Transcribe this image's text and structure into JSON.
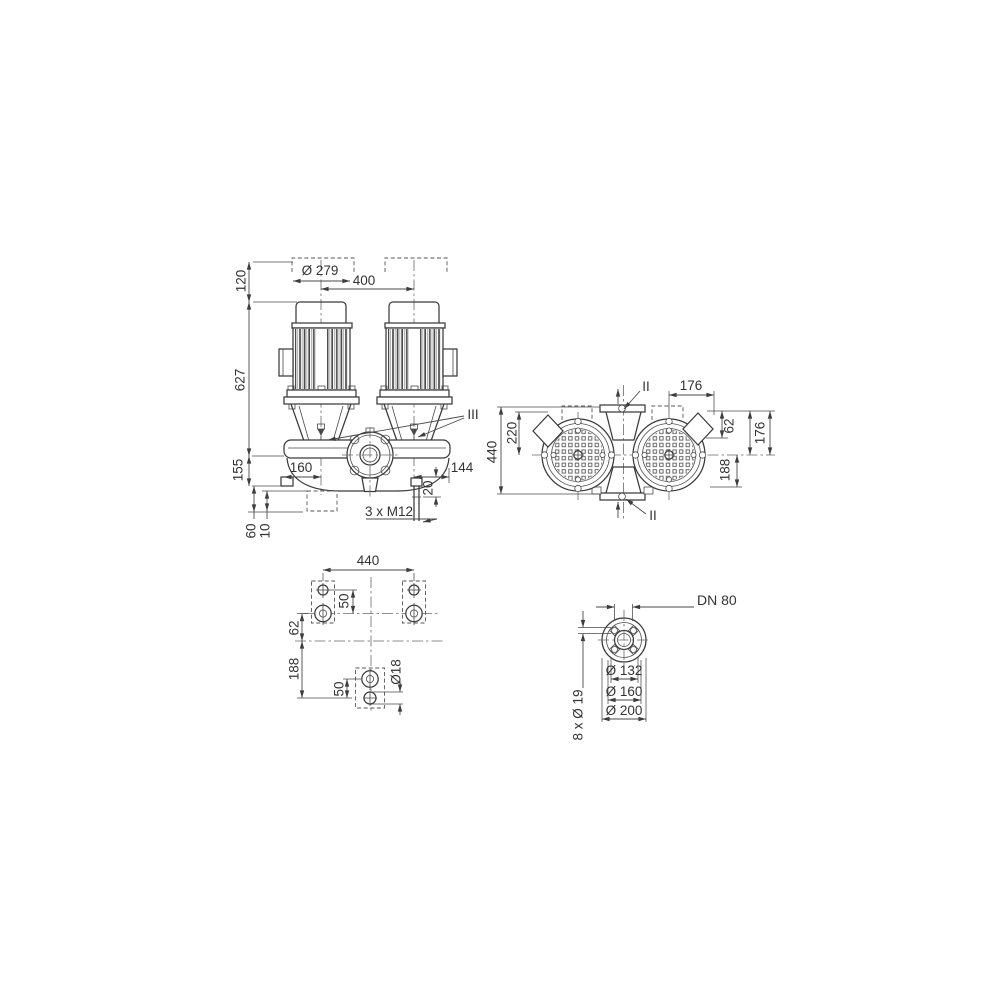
{
  "front": {
    "d120": "120",
    "d627": "627",
    "d155": "155",
    "d279": "Ø 279",
    "d400": "400",
    "d160": "160",
    "d144": "144",
    "d20": "20",
    "m12": "3 x M12",
    "d60": "60",
    "d10": "10",
    "ref3": "III"
  },
  "top": {
    "d440": "440",
    "d220": "220",
    "d176_top": "176",
    "sec_top": "II",
    "sec_bottom": "II",
    "d62": "62",
    "d176_right": "176",
    "d188": "188"
  },
  "foundation": {
    "d440": "440",
    "d50_top": "50",
    "d62": "62",
    "d188": "188",
    "d50_bottom": "50",
    "d18": "Ø18"
  },
  "flange": {
    "dn": "DN 80",
    "holes": "8 x Ø 19",
    "d132": "Ø 132",
    "d160": "Ø 160",
    "d200": "Ø 200"
  }
}
